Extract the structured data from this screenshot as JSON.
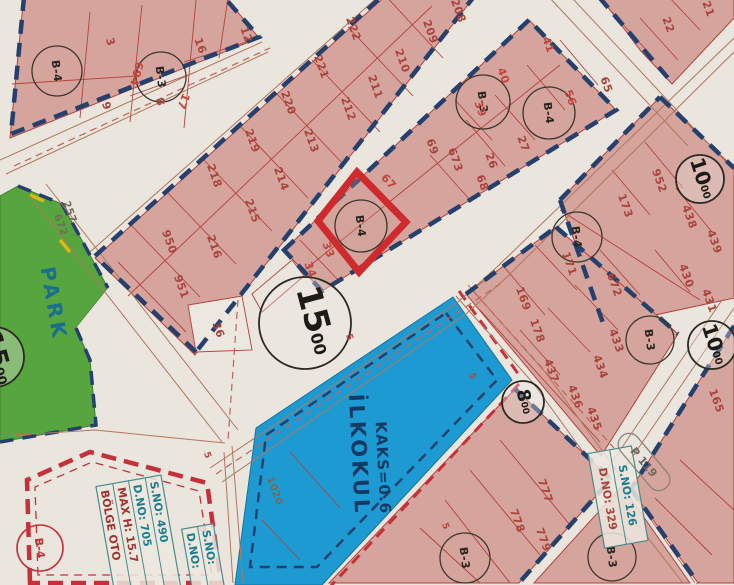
{
  "zones": {
    "school": {
      "name": "İLKOKUL",
      "kaks": "KAKS=0.6",
      "parcel": "1020"
    },
    "park": {
      "label": "PARK",
      "num_a": "257",
      "num_b": "672"
    },
    "parking": {
      "title": "BÖLGE OTO",
      "max_h": "MAX H: 15.7",
      "sno": "S.NO: 490",
      "dno": "D.NO: 705"
    },
    "small_box": {
      "sno": "S.NO:",
      "dno": "D.NO:"
    },
    "junction_box": {
      "sno": "S.NO: 126",
      "dno": "D.NO: 329",
      "p_marker": "P 119"
    }
  },
  "road_circles": {
    "main15": {
      "v": "15",
      "s": "00"
    },
    "left15": {
      "v": "15",
      "s": "00"
    },
    "top10": {
      "v": "10",
      "s": "00"
    },
    "right10": {
      "v": "10",
      "s": "00"
    },
    "mid8": {
      "v": "8",
      "s": "00"
    }
  },
  "block_circles": {
    "b4a": "B-4",
    "b3a": "B-3",
    "b3b": "B-3",
    "b4b": "B-4",
    "b4c": "B-4",
    "b3c": "B-3",
    "b3d": "B-3",
    "b3e": "B-3",
    "b4red": "B-4",
    "b4mid": "B-4"
  },
  "dims": {
    "d5": "5"
  },
  "parcels": {
    "p3": "3",
    "p9": "9",
    "p8": "8",
    "p16": "16",
    "p12": "12",
    "p17": "17",
    "p694": "694",
    "p222": "222",
    "p221": "221",
    "p220": "220",
    "p219": "219",
    "p218": "218",
    "p950": "950",
    "p951": "951",
    "p216": "216",
    "p215": "215",
    "p214": "214",
    "p213": "213",
    "p212": "212",
    "p211": "211",
    "p210": "210",
    "p209": "209",
    "p208": "208",
    "p33": "33",
    "p34": "34",
    "p36": "36",
    "p67": "67",
    "p69": "69",
    "p673": "673",
    "p68": "68",
    "p26": "26",
    "p27": "27",
    "p39": "39",
    "p40": "40",
    "p41": "41",
    "p56": "56",
    "p65": "65",
    "p22": "22",
    "p21": "21",
    "p952": "952",
    "p173": "173",
    "p438": "438",
    "p439": "439",
    "p430": "430",
    "p431": "431",
    "p672b": "672",
    "p171": "171",
    "p169": "169",
    "p178": "178",
    "p437": "437",
    "p436": "436",
    "p435": "435",
    "p434": "434",
    "p433": "433",
    "p165": "165",
    "p777": "777",
    "p778": "778",
    "p779": "779",
    "p257": "257",
    "p672a": "672",
    "p1020": "1020"
  }
}
